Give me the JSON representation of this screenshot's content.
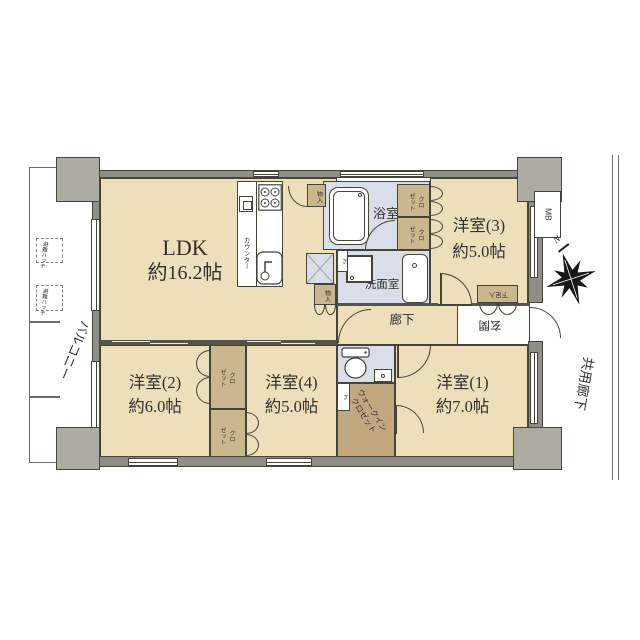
{
  "balcony": {
    "label": "バルコニー",
    "hatch": "避難ハッチ"
  },
  "rooms": {
    "ldk": {
      "name": "LDK",
      "size": "約16.2帖"
    },
    "yoshitsu1": {
      "name": "洋室(1)",
      "size": "約7.0帖"
    },
    "yoshitsu2": {
      "name": "洋室(2)",
      "size": "約6.0帖"
    },
    "yoshitsu3": {
      "name": "洋室(3)",
      "size": "約5.0帖"
    },
    "yoshitsu4": {
      "name": "洋室(4)",
      "size": "約5.0帖"
    },
    "bath": {
      "name": "浴室"
    },
    "washroom": {
      "name": "洗面室"
    },
    "hallway": {
      "name": "廊下"
    },
    "genkan": {
      "name": "玄関"
    }
  },
  "storage": {
    "closet_l1": "クロ",
    "closet_l2": "ゼット",
    "wic_l1": "ウォークイン",
    "wic_l2": "クロゼット",
    "shoe": "下足入",
    "mono": "物入"
  },
  "kitchen": {
    "counter": "カウンター"
  },
  "exterior": {
    "corridor": "共用廊下",
    "meter_box": "MB",
    "pipe_space": "PS",
    "north": "N"
  },
  "colors": {
    "room_fill": "#ECDFBA",
    "wet_fill": "#D9DEE8",
    "closet_fill": "#C9B78D",
    "wic_fill": "#C2A87E",
    "wall_fill": "#8F8F87",
    "line": "#45443A"
  }
}
